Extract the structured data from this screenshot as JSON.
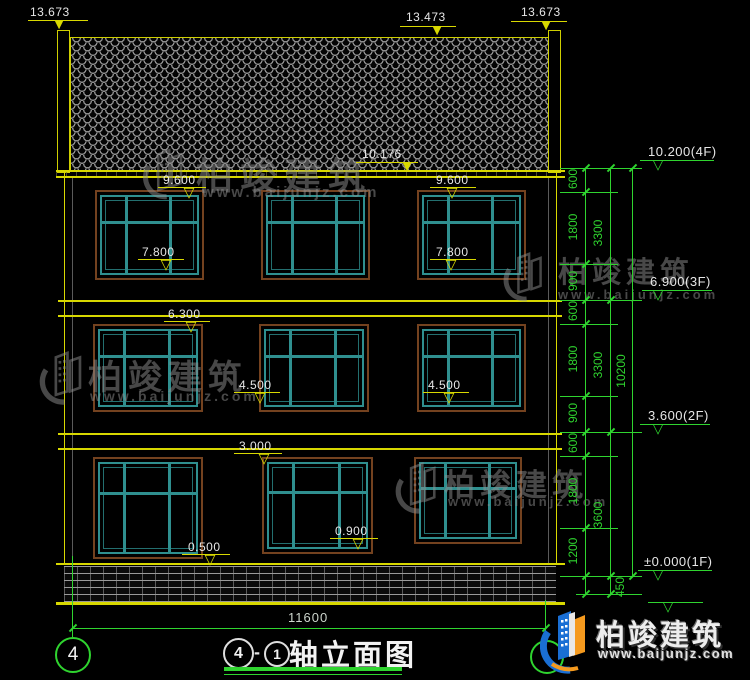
{
  "watermarks": {
    "brand": "柏竣建筑",
    "url": "www.baijunjz.com"
  },
  "logo": {
    "brand": "柏竣建筑",
    "url": "www.baijunjz.com"
  },
  "drawing_title": {
    "axis_start": "4",
    "separator": "-",
    "axis_end": "1",
    "name": "轴立面图"
  },
  "axis_bubble_left": "4",
  "levels": {
    "roof_left": "13.673",
    "roof_ridge": "13.473",
    "roof_right": "13.673",
    "eave": "10.176",
    "f3_top_left": "9.600",
    "f3_top_right": "9.600",
    "f3_sill_left": "7.800",
    "f3_sill_right": "7.800",
    "f2_top": "6.300",
    "f2_sill_left": "4.500",
    "f2_sill_right": "4.500",
    "f1_top": "3.000",
    "f1_sill_left": "0.500",
    "f1_sill_right": "0.900"
  },
  "story_levels": {
    "f4": "10.200(4F)",
    "f3": "6.900(3F)",
    "f2": "3.600(2F)",
    "f1": "±0.000(1F)"
  },
  "chain": {
    "col1": [
      "600",
      "1800",
      "900",
      "600",
      "1800",
      "900",
      "600",
      "1800",
      "1200"
    ],
    "col2": [
      "3300",
      "3300",
      "3600"
    ],
    "total": "10200",
    "plinth": "450"
  },
  "bottom_dim": "11600",
  "colors": {
    "line_yellow": "#d8d800",
    "line_green": "#2fd42f",
    "window_teal": "#2f8f8f",
    "window_brown": "#74421f",
    "text_white": "#e6e6e6",
    "logo_blue": "#1a6fd4",
    "logo_orange": "#f59a1e"
  }
}
